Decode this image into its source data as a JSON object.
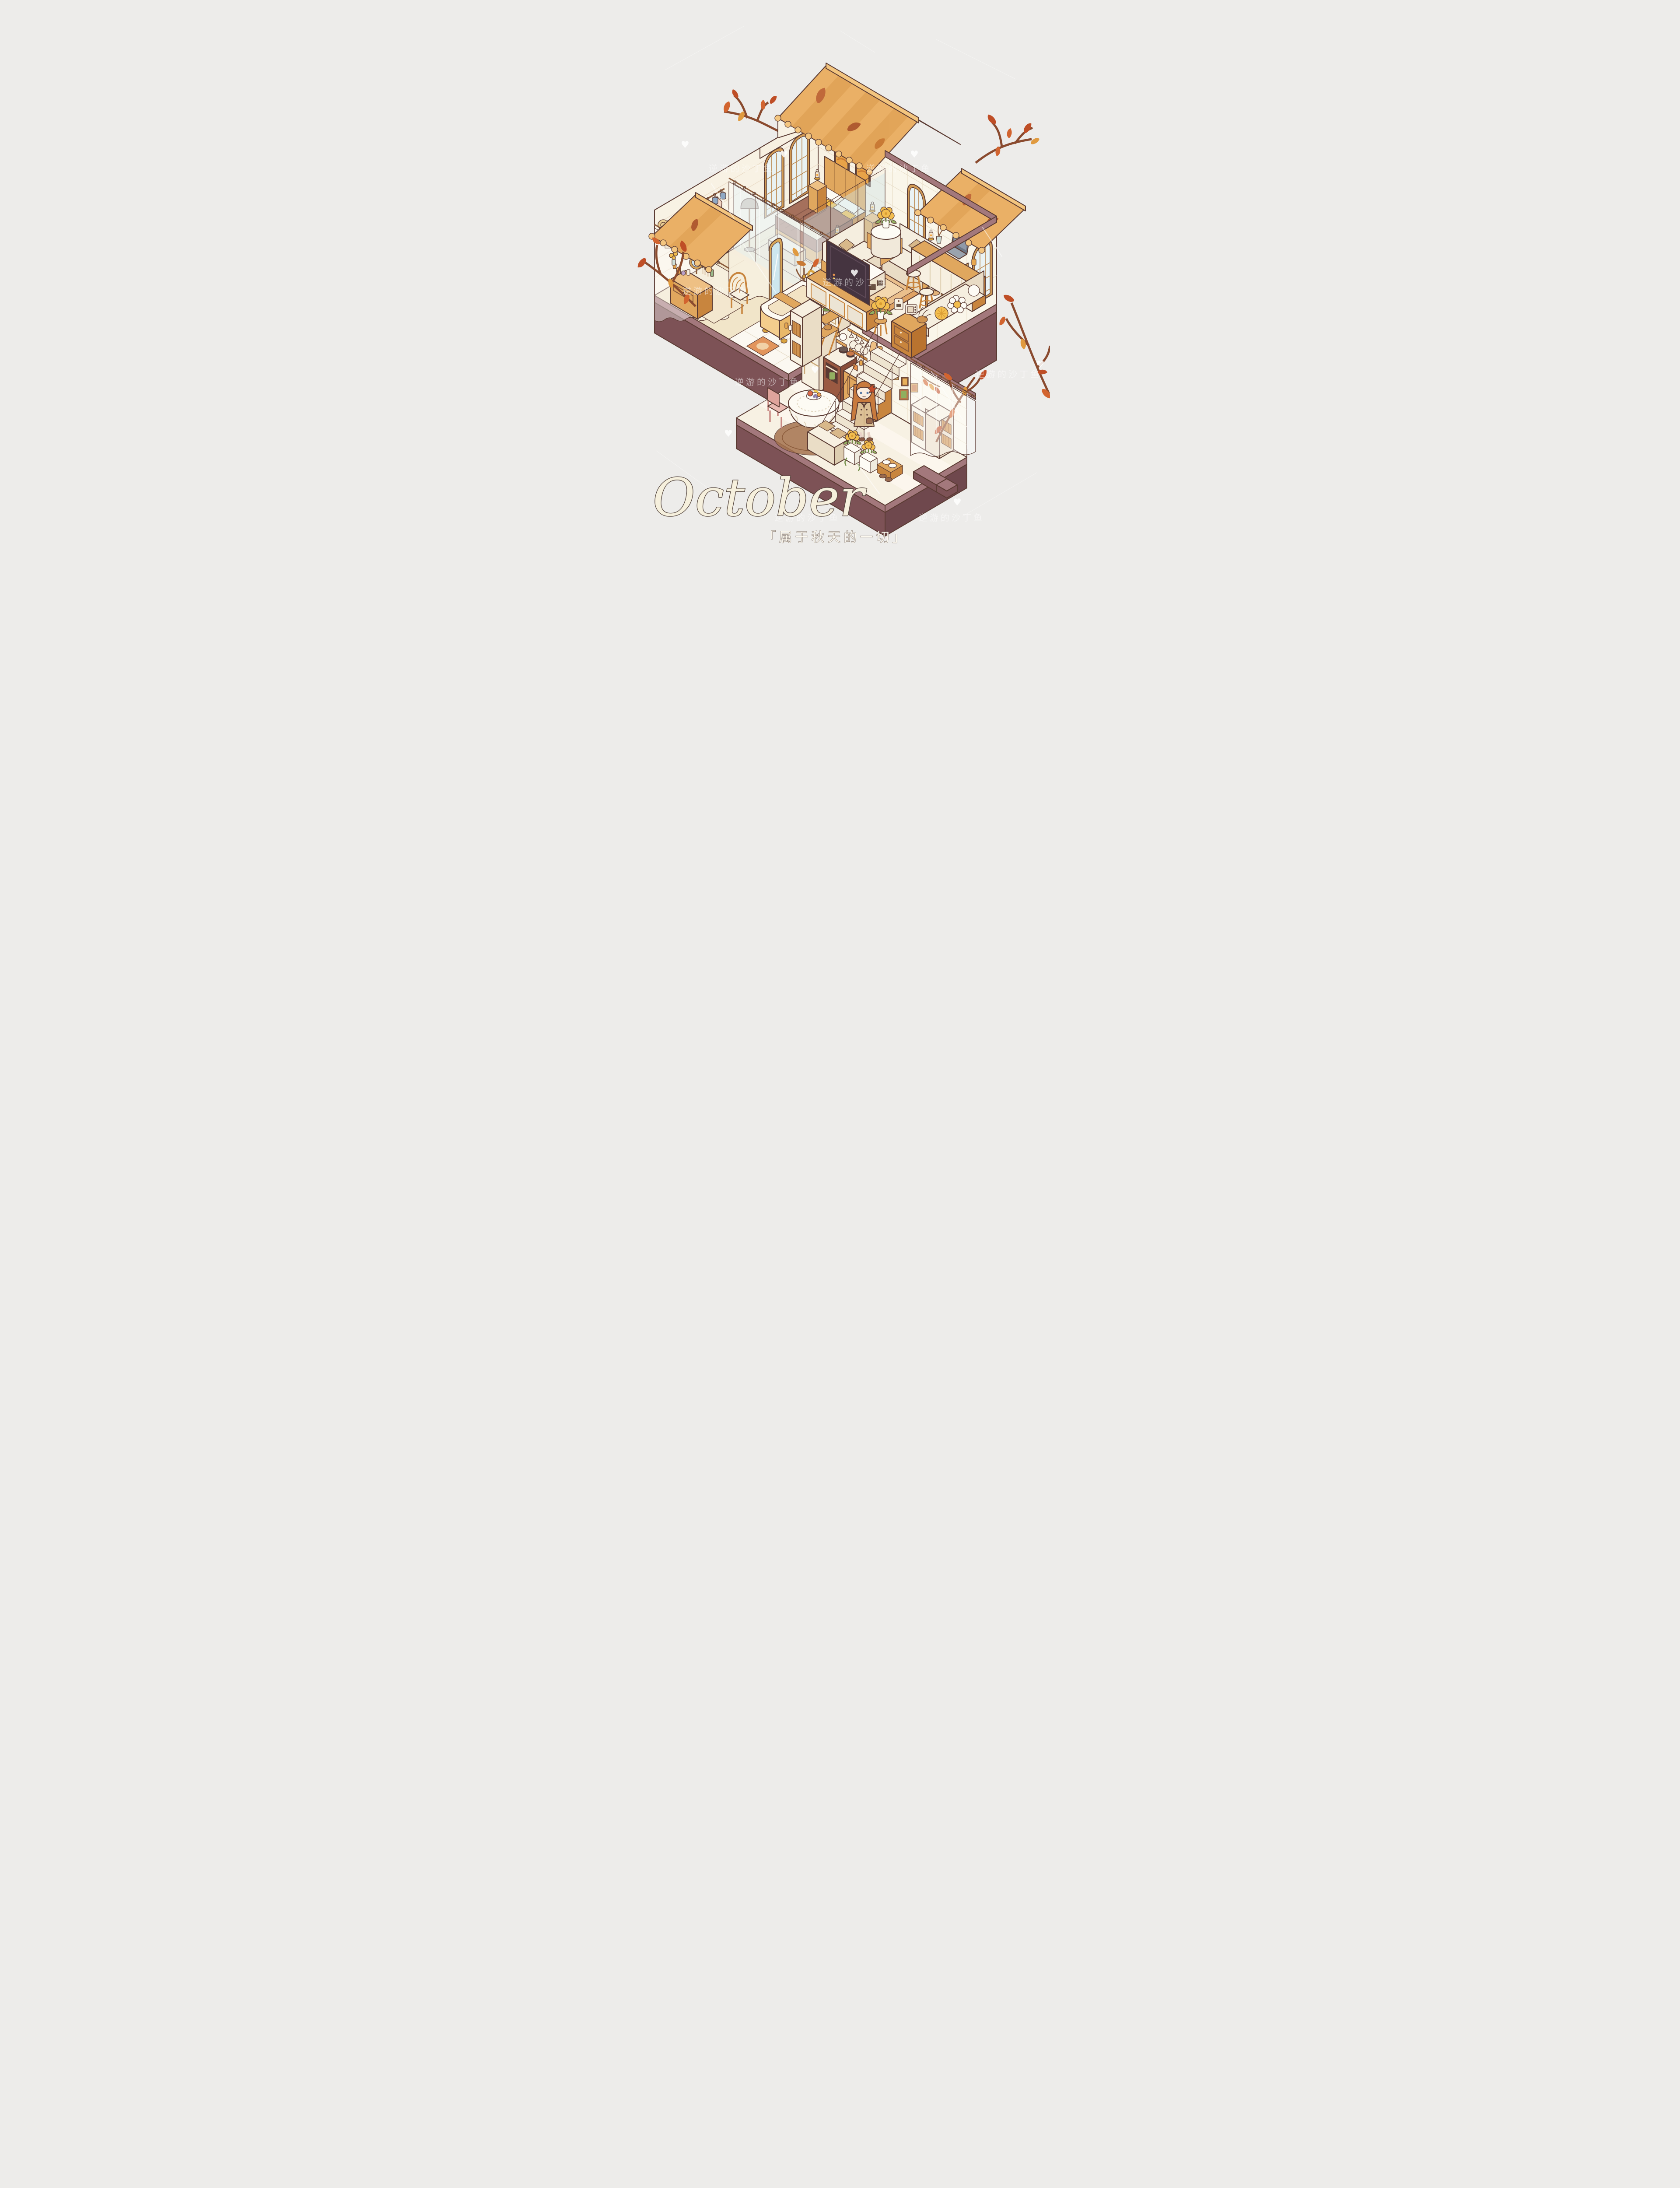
{
  "artwork": {
    "title": "October",
    "subtitle": "「属于秋天的一切」",
    "watermark": "逆游的沙丁鱼",
    "heart": "♥"
  },
  "scene": {
    "style": "isometric cutaway dollhouse illustration, autumn theme",
    "floors": [
      {
        "name": "upper floor",
        "rooms": [
          {
            "name": "bedroom",
            "items": [
              "double bed with brown striped duvet",
              "wood slat headboard",
              "cream and mustard pillows",
              "two nightstands with candle lanterns",
              "two framed autumn paintings",
              "tall arched lattice windows",
              "foot bench",
              "floor lamp",
              "area rug",
              "small cabinet with lantern and vase"
            ]
          },
          {
            "name": "walk-in closet",
            "items": [
              "clothes rail with hanging coats and dresses",
              "two blue bags",
              "straw hat",
              "sheer curtains",
              "gold arched standing mirror",
              "vanity table with perfume bottles, brushes and round mirror",
              "rattan chair",
              "wood plank floor"
            ]
          },
          {
            "name": "bathroom",
            "items": [
              "clawfoot bathtub with wooden tray and gold faucet",
              "vessel-sink vanity cabinet",
              "ladder shelf with towels and toiletries",
              "tall cabinet with wicker drawers",
              "autumn potted plant",
              "orange bath mat",
              "white tile floor"
            ]
          },
          {
            "name": "living room",
            "items": [
              "two cream sofas with tan pillows",
              "white rounded coffee table",
              "layered orange rug",
              "flat TV on long media console",
              "round side table with yellow chrysanthemums",
              "glass partition walls"
            ]
          },
          {
            "name": "breakfast bar nook",
            "items": [
              "wooden bar counter with laptop, iced drink, lantern and twig vase",
              "two wooden stools",
              "curved bench with flower-shaped pillows",
              "wall shelves with books, jam jar and gift boxes",
              "two framed bread prints",
              "corner slatted lamp",
              "cabinet with coffee machine, mini oven and baguette basket",
              "potted yellow mums on stand",
              "arched rattan windows"
            ]
          }
        ]
      },
      {
        "name": "lower floor",
        "rooms": [
          {
            "name": "kitchen",
            "items": [
              "cream refrigerator",
              "stove with two pots and oven door with green towel",
              "sink counter with wooden cabinets",
              "open shelves with jars, teapot, plates and cutting boards",
              "hanging stemware rack",
              "row of small framed pictures",
              "leaf garland",
              "round table with lace tablecloth and fruit plate",
              "pink chair",
              "brown oval rug",
              "two cream cabinets with wicker baskets",
              "staircase with white railing",
              "bench with tan pillows",
              "white planters with yellow flowers",
              "shoe shelf with sneakers",
              "sheer curtain with autumn branch behind"
            ]
          }
        ]
      }
    ],
    "character": {
      "description": "girl with long ginger hair, red maple hair pin, beige double-breasted trench coat, dark tie, holding a brown bag",
      "location": "lower kitchen, right of the round table"
    },
    "exterior": [
      "corrugated tan roofs with fallen leaves",
      "white brick gable",
      "autumn branches with red and orange leaves",
      "mauve display base",
      "small outdoor steps at lower right"
    ],
    "palette": {
      "background": "#edecea",
      "roof": "#eab066",
      "roof_shade": "#d99a4c",
      "wall_brick": "#f8f2e4",
      "wall_tile": "#faf6ea",
      "wood": "#e0a75e",
      "wood_dark": "#c8853e",
      "cream": "#f7f0e1",
      "base_top": "#a3787c",
      "base_front": "#7d5256",
      "rug": "#dfa264",
      "leaf_orange": "#d2642f",
      "leaf_red": "#bf4e26",
      "flower_yellow": "#f2bd4e",
      "outline": "#5b3b33"
    }
  }
}
